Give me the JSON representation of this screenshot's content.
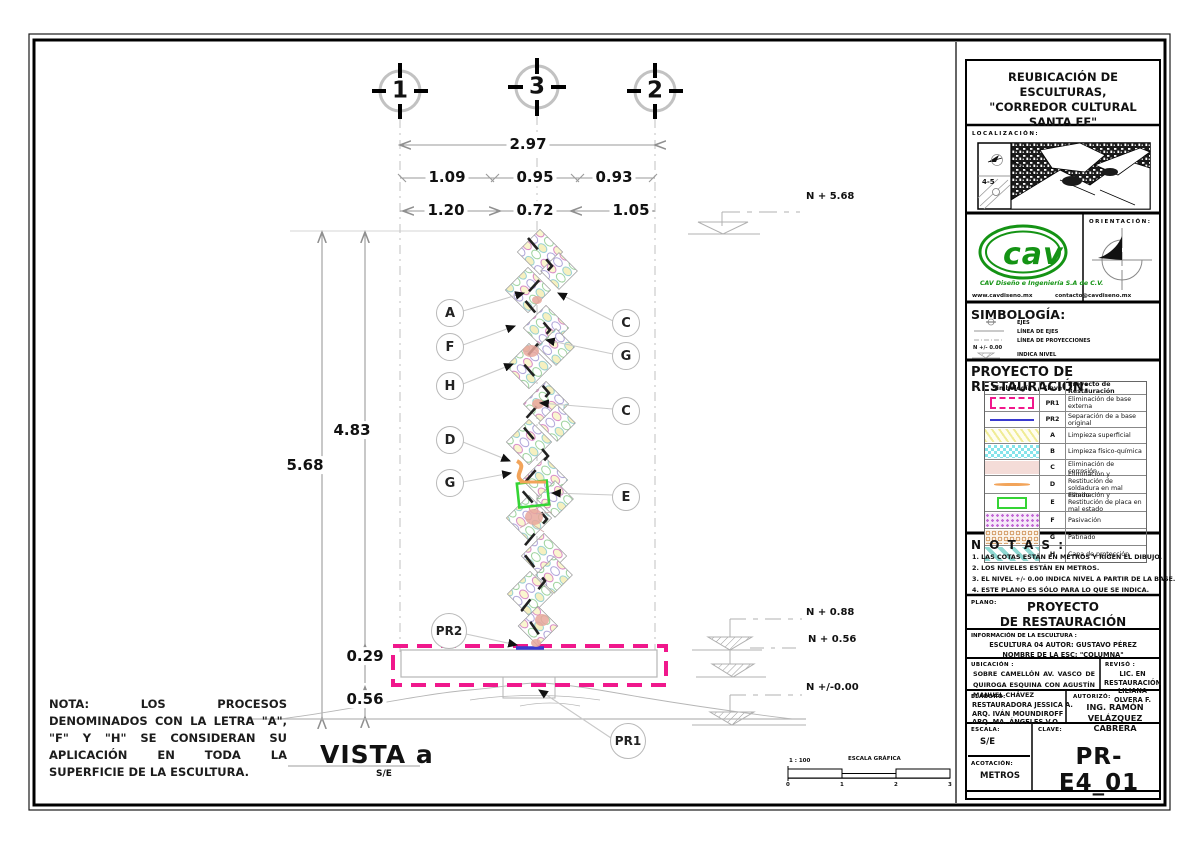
{
  "colors": {
    "pr1_pink": "#f0188c",
    "pr2_blue": "#3a3ad0",
    "weld_orange": "#f2a45a",
    "plate_green": "#35d435",
    "cav_green": "#149314",
    "axis_gray": "#c2c2c2"
  },
  "drawing": {
    "grid_axes": [
      "1",
      "3",
      "2"
    ],
    "dims": {
      "overall": "2.97",
      "span_top": [
        "1.09",
        "0.95",
        "0.93"
      ],
      "span_mid": [
        "1.20",
        "0.72",
        "1.05"
      ],
      "total_height": "5.68",
      "shaft_height": "4.83",
      "base_height": "0.29",
      "below_base": "0.56"
    },
    "levels": {
      "top": "N + 5.68",
      "base_top": "N + 0.88",
      "base_mid": "N + 0.56",
      "ground": "N +/-0.00"
    },
    "callouts_left": [
      "A",
      "F",
      "H",
      "D",
      "G"
    ],
    "callouts_right": [
      "C",
      "G",
      "C",
      "E"
    ],
    "callout_pr2": "PR2",
    "callout_pr1": "PR1",
    "vista": {
      "title": "VISTA a",
      "scale": "S/E"
    },
    "nota": "NOTA: LOS PROCESOS DENOMINADOS CON LA LETRA \"A\", \"F\" Y \"H\" SE CONSIDERAN SU APLICACIÓN EN TODA LA SUPERFICIE DE LA ESCULTURA.",
    "scale_bar": {
      "ratio": "1 : 100",
      "label": "ESCALA GRÁFICA",
      "ticks": [
        "0",
        "1",
        "2",
        "3"
      ]
    }
  },
  "title_block": {
    "project_title_lines": [
      "REUBICACIÓN DE ESCULTURAS,",
      "\"CORREDOR CULTURAL",
      "SANTA FE\""
    ],
    "localizacion": {
      "label": "LOCALIZACIÓN:",
      "grid_ref": "4-5"
    },
    "orientacion_label": "ORIENTACIÓN:",
    "logo": {
      "word": "cav",
      "company": "CAV Diseño e Ingeniería S.A de C.V.",
      "website": "www.cavdiseno.mx",
      "email": "contacto@cavdiseno.mx"
    },
    "simbologia": {
      "heading": "SIMBOLOGÍA:",
      "items": [
        {
          "label": "EJES"
        },
        {
          "label": "LÍNEA DE EJES"
        },
        {
          "label": "LÍNEA DE PROYECCIONES"
        },
        {
          "prefix": "N +/- 0.00",
          "label": "INDICA NIVEL"
        }
      ]
    },
    "legend": {
      "heading": "PROYECTO DE RESTAURACIÓN:",
      "headers": [
        "Simbología",
        "Clave",
        "Proyecto de Restauración"
      ],
      "rows": [
        {
          "swatch": "pink-dashed-rect",
          "clave": "PR1",
          "desc": "Eliminación de base externa"
        },
        {
          "swatch": "blue-line",
          "clave": "PR2",
          "desc": "Separación de a base original"
        },
        {
          "swatch": "yellow-hatch",
          "clave": "A",
          "desc": "Limpieza superficial"
        },
        {
          "swatch": "cyan-checker",
          "clave": "B",
          "desc": "Limpieza físico-química"
        },
        {
          "swatch": "pink-fill",
          "clave": "C",
          "desc": "Eliminación de corrosión"
        },
        {
          "swatch": "orange-line",
          "clave": "D",
          "desc": "Eliminación y Restitución de soldadura en mal estado"
        },
        {
          "swatch": "green-rect",
          "clave": "E",
          "desc": "Eliminación y Restitución de placa en mal estado"
        },
        {
          "swatch": "purple-dots",
          "clave": "F",
          "desc": "Pasivación"
        },
        {
          "swatch": "tan-circles",
          "clave": "G",
          "desc": "Patinado"
        },
        {
          "swatch": "teal-stripes",
          "clave": "H",
          "desc": "Capa de protección"
        }
      ]
    },
    "notas": {
      "heading": "N O T A S :",
      "items": [
        "1. LAS COTAS ESTÁN EN METROS Y  RIGEN EL DIBUJO.",
        "2. LOS NIVELES ESTÁN EN METROS.",
        "3. EL NIVEL +/- 0.00 INDICA NIVEL A PARTIR DE LA BASE.",
        "4. ESTE PLANO ES SÓLO PARA LO QUE SE INDICA."
      ]
    },
    "plano": {
      "label": "PLANO:",
      "line1": "PROYECTO",
      "line2": "DE RESTAURACIÓN"
    },
    "info": {
      "label": "INFORMACIÓN DE LA ESCULTURA :",
      "line1": "ESCULTURA 04 AUTOR: GUSTAVO PÉREZ",
      "line2": "NOMBRE DE LA ESC: \"COLUMNA\""
    },
    "ubicacion": {
      "label": "UBICACIÓN :",
      "text": "SOBRE CAMELLÓN AV. VASCO DE QUIROGA ESQUINA CON AGUSTÍN MANUEL CHÁVEZ"
    },
    "reviso": {
      "label": "REVISÓ :",
      "line1": "LIC. EN RESTAURACIÓN",
      "line2": "LILIANA OLVERA F."
    },
    "elaboro": {
      "label": "ELABORÓ:",
      "lines": [
        "RESTAURADORA JESSICA A.",
        "ARQ. IVÁN MOUNDIROFF",
        "ARQ. MA. ÁNGELES V.O"
      ]
    },
    "autorizo": {
      "label": "AUTORIZÓ:",
      "line1": "ING. RAMÓN VELÁZQUEZ",
      "line2": "CABRERA"
    },
    "escala": {
      "label": "ESCALA:",
      "value": "S/E"
    },
    "acotacion": {
      "label": "ACOTACIÓN:",
      "value": "METROS"
    },
    "clave": {
      "label": "CLAVE:",
      "value": "PR-E4_01"
    }
  }
}
